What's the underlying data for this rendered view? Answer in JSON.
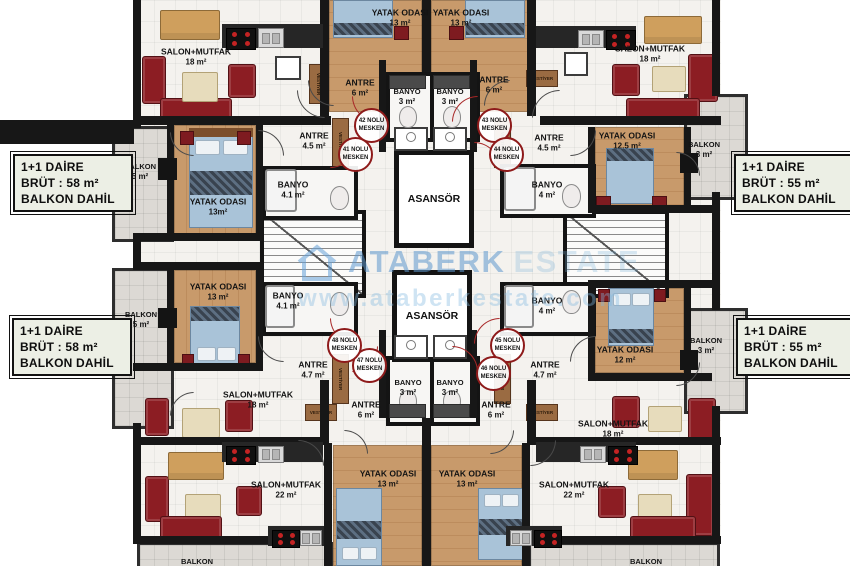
{
  "info_boxes": {
    "top_left": {
      "l1": "1+1 DAİRE",
      "l2": "BRÜT  : 58 m²",
      "l3": "BALKON DAHİL"
    },
    "top_right": {
      "l1": "1+1 DAİRE",
      "l2": "BRÜT  : 55 m²",
      "l3": "BALKON DAHİL"
    },
    "bottom_left": {
      "l1": "1+1 DAİRE",
      "l2": "BRÜT  : 58 m²",
      "l3": "BALKON DAHİL"
    },
    "bottom_right": {
      "l1": "1+1 DAİRE",
      "l2": "BRÜT  : 55 m²",
      "l3": "BALKON DAHİL"
    }
  },
  "core": {
    "elevator": "ASANSÖR"
  },
  "meskens": [
    {
      "no": "41 NOLU",
      "word": "MESKEN"
    },
    {
      "no": "42 NOLU",
      "word": "MESKEN"
    },
    {
      "no": "43 NOLU",
      "word": "MESKEN"
    },
    {
      "no": "44 NOLU",
      "word": "MESKEN"
    },
    {
      "no": "45 NOLU",
      "word": "MESKEN"
    },
    {
      "no": "46 NOLU",
      "word": "MESKEN"
    },
    {
      "no": "47 NOLU",
      "word": "MESKEN"
    },
    {
      "no": "48 NOLU",
      "word": "MESKEN"
    }
  ],
  "rooms": [
    {
      "label": "SALON+MUTFAK",
      "area": "18 m²"
    },
    {
      "label": "YATAK ODASI",
      "area": "13 m²"
    },
    {
      "label": "YATAK ODASI",
      "area": "13 m²"
    },
    {
      "label": "SALON+MUTFAK",
      "area": "18 m²"
    },
    {
      "label": "ANTRE",
      "area": "6 m²"
    },
    {
      "label": "ANTRE",
      "area": "6 m²"
    },
    {
      "label": "BANYO",
      "area": "3 m²"
    },
    {
      "label": "BANYO",
      "area": "3 m²"
    },
    {
      "label": "BALKON",
      "area": "5 m²"
    },
    {
      "label": "ANTRE",
      "area": "4.5 m²"
    },
    {
      "label": "BANYO",
      "area": "4.1 m²"
    },
    {
      "label": "YATAK ODASI",
      "area": "13m²"
    },
    {
      "label": "ANTRE",
      "area": "4.5 m²"
    },
    {
      "label": "YATAK ODASI",
      "area": "12.5 m²"
    },
    {
      "label": "BANYO",
      "area": "4 m²"
    },
    {
      "label": "BALKON",
      "area": "3 m²"
    },
    {
      "label": "YATAK ODASI",
      "area": "13 m²"
    },
    {
      "label": "BANYO",
      "area": "4.1 m²"
    },
    {
      "label": "BALKON",
      "area": "5 m²"
    },
    {
      "label": "ANTRE",
      "area": "4.7 m²"
    },
    {
      "label": "BANYO",
      "area": "4 m²"
    },
    {
      "label": "YATAK ODASI",
      "area": "12 m²"
    },
    {
      "label": "BALKON",
      "area": "3 m²"
    },
    {
      "label": "ANTRE",
      "area": "4.7 m²"
    },
    {
      "label": "SALON+MUTFAK",
      "area": "18 m²"
    },
    {
      "label": "ANTRE",
      "area": "6 m²"
    },
    {
      "label": "BANYO",
      "area": "3 m²"
    },
    {
      "label": "BANYO",
      "area": "3 m²"
    },
    {
      "label": "ANTRE",
      "area": "6 m²"
    },
    {
      "label": "SALON+MUTFAK",
      "area": "18 m²"
    },
    {
      "label": "SALON+MUTFAK",
      "area": "22 m²"
    },
    {
      "label": "YATAK ODASI",
      "area": "13 m²"
    },
    {
      "label": "YATAK ODASI",
      "area": "13 m²"
    },
    {
      "label": "SALON+MUTFAK",
      "area": "22 m²"
    },
    {
      "label": "BALKON",
      "area": ""
    },
    {
      "label": "BALKON",
      "area": ""
    }
  ],
  "vestiyer": "VESTİYER",
  "watermark": {
    "brand": "ATABERK",
    "brand2": "ESTATE",
    "url": "www.ataberkestate.com"
  },
  "colors": {
    "wall": "#171717",
    "wood": "#c89a6b",
    "sofa": "#8c1d23",
    "circle": "#8e1a1a",
    "watermark": "#5c98cd",
    "balcony": "#dcd9d4",
    "info_bg": "#ecefe5"
  }
}
